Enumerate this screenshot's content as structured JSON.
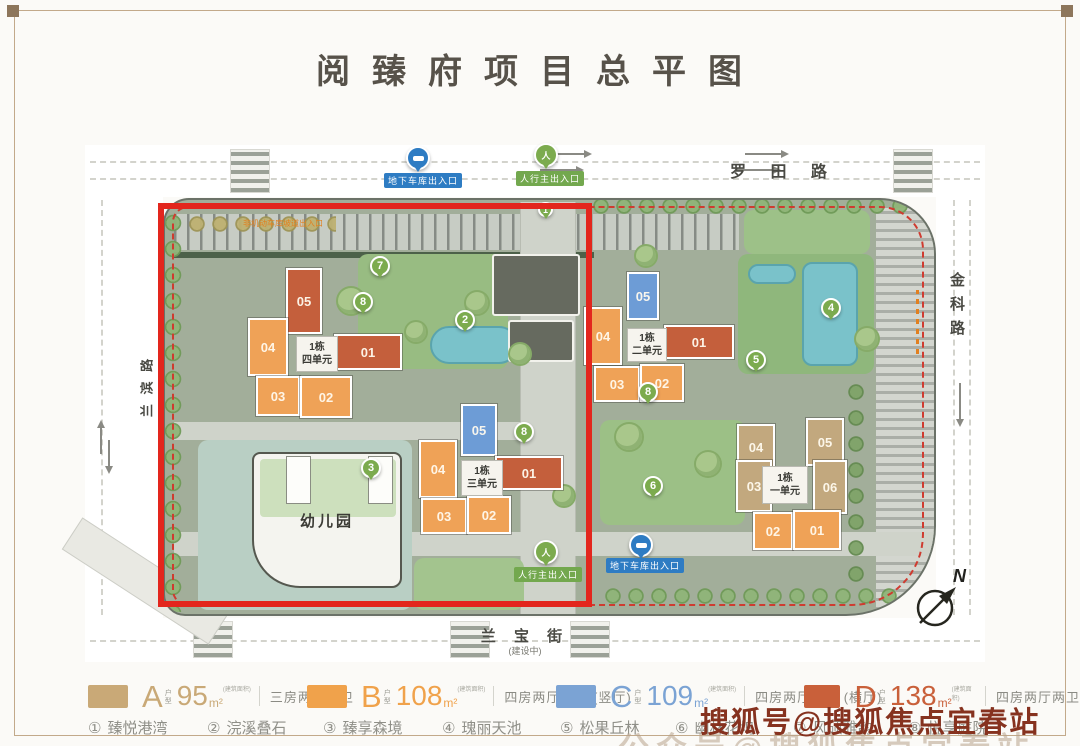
{
  "title": "阅臻府项目总平图",
  "map": {
    "roads": {
      "top": "罗 田 路",
      "right": "金科路",
      "left": "兰 滨 路",
      "bottom": "兰 宝 街",
      "bottom_note": "(建设中)"
    },
    "entrances": {
      "garage": "地下车库出入口",
      "pedestrian": "人行主出入口"
    },
    "icons": {
      "pedestrian": "人"
    },
    "ramp_note": "非机动车库坡道出入口",
    "kindergarten": "幼儿园",
    "compass": "N",
    "clusters": [
      {
        "name": "1栋",
        "unit": "四单元",
        "buildings": [
          "05",
          "04",
          "03",
          "02",
          "01"
        ]
      },
      {
        "name": "1栋",
        "unit": "三单元",
        "buildings": [
          "05",
          "04",
          "03",
          "02",
          "01"
        ]
      },
      {
        "name": "1栋",
        "unit": "二单元",
        "buildings": [
          "05",
          "04",
          "03",
          "02",
          "01"
        ]
      },
      {
        "name": "1栋",
        "unit": "一单元",
        "buildings": [
          "04",
          "05",
          "03",
          "06",
          "02",
          "01"
        ]
      }
    ],
    "pins": [
      "7",
      "8",
      "2",
      "8",
      "8",
      "5",
      "4",
      "6",
      "3",
      "1"
    ]
  },
  "legend": {
    "items": [
      {
        "letter": "A",
        "type_label": "户型",
        "area": "95",
        "unit": "m²",
        "area_note": "(建筑面积)",
        "desc": "三房两厅两卫",
        "color": "#c9a977"
      },
      {
        "letter": "B",
        "type_label": "户型",
        "area": "108",
        "unit": "m²",
        "area_note": "(建筑面积)",
        "desc": "四房两厅两卫 (竖厅)",
        "color": "#f0a24b"
      },
      {
        "letter": "C",
        "type_label": "户型",
        "area": "109",
        "unit": "m²",
        "area_note": "(建筑面积)",
        "desc": "四房两厅两卫 (横厅)",
        "color": "#7ba3d4"
      },
      {
        "letter": "D",
        "type_label": "户型",
        "area": "138",
        "unit": "m²",
        "area_note": "(建筑面积)",
        "desc": "四房两厅两卫",
        "color": "#c9603a"
      }
    ]
  },
  "features": [
    {
      "num": "①",
      "name": "臻悦港湾"
    },
    {
      "num": "②",
      "name": "浣溪叠石"
    },
    {
      "num": "③",
      "name": "臻享森境"
    },
    {
      "num": "④",
      "name": "瑰丽天池"
    },
    {
      "num": "⑤",
      "name": "松果丘林"
    },
    {
      "num": "⑥",
      "name": "幽林花坞"
    },
    {
      "num": "⑦",
      "name": "风硕雅韵"
    },
    {
      "num": "⑧",
      "name": "悦享庭院"
    }
  ],
  "watermark": {
    "line1": "搜狐号@搜狐焦点宜春站",
    "line2": "公众号@搜狐焦点宜春站"
  },
  "colors": {
    "highlight_red": "#e3261d",
    "boundary_dash_red": "#cf3b30",
    "type_a": "#c9a977",
    "type_b": "#f0a24b",
    "type_c": "#7ba3d4",
    "type_d": "#c9603a",
    "pin_green": "#7cab4e",
    "entrance_blue": "#2e7cc3",
    "entrance_green": "#73a84e",
    "water_teal": "#7ac2ca",
    "watermark_brown": "#86321f"
  }
}
